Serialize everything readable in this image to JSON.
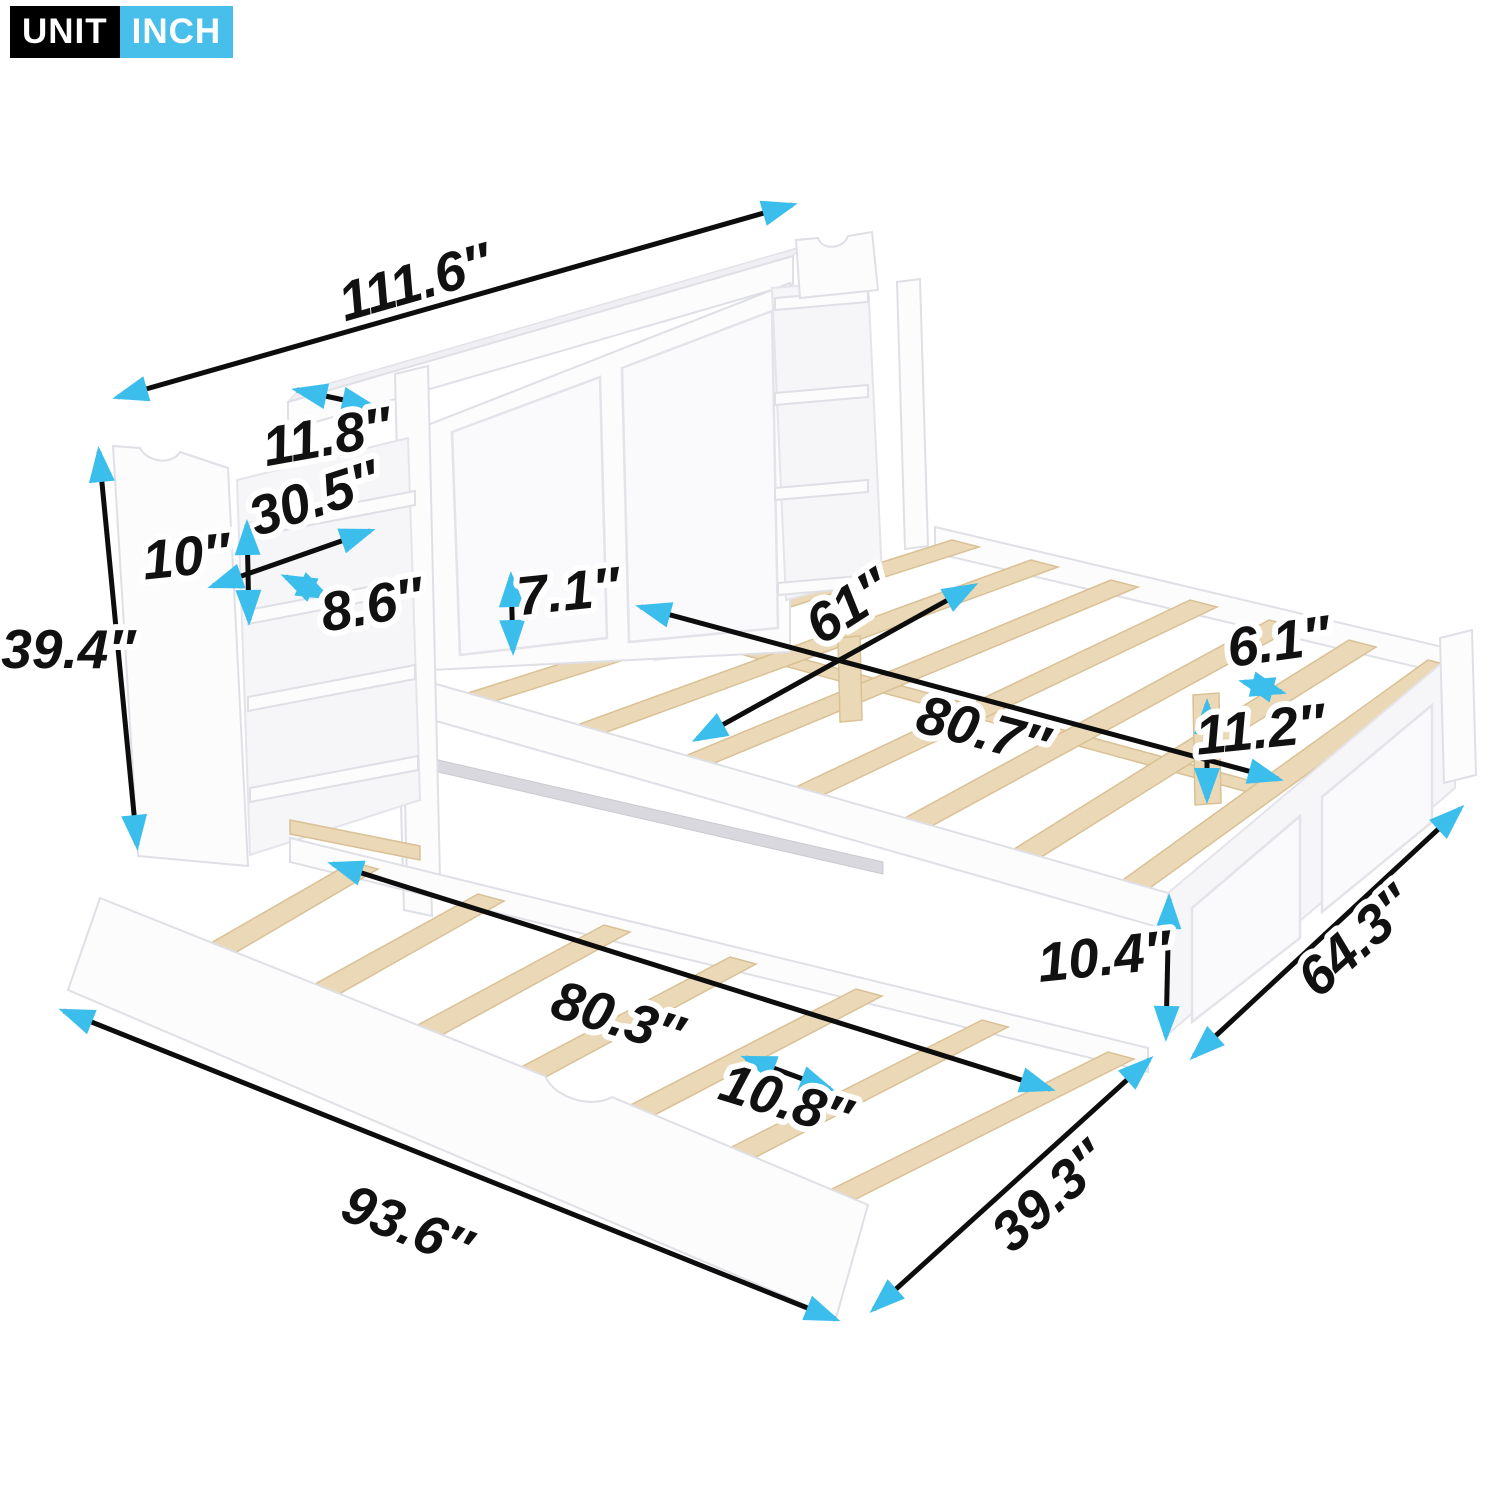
{
  "badge": {
    "unit_label": "UNIT",
    "unit_value": "INCH"
  },
  "colors": {
    "arrow": "#3bbeec",
    "badge_unit_bg": "#000000",
    "badge_inch_bg": "#47bfea",
    "dimension_line": "#0d0d0d",
    "wood": "#ebd8b6",
    "panel": "#fcfcfd"
  },
  "dimensions": {
    "overall_width": "111.6″",
    "headboard_depth": "11.8″",
    "bookshelf_width": "30.5″",
    "bookshelf_opening_height": "10″",
    "bookshelf_depth": "8.6″",
    "headboard_height": "39.4″",
    "rail_height": "7.1″",
    "bed_inner_width": "61″",
    "bed_inner_length": "80.7″",
    "slat_spacing": "6.1″",
    "support_leg_height": "11.2″",
    "side_rail_height": "10.4″",
    "bed_outer_width": "64.3″",
    "trundle_inner_length": "80.3″",
    "trundle_slat_spacing": "10.8″",
    "trundle_outer_length": "93.6″",
    "trundle_width": "39.3″"
  }
}
